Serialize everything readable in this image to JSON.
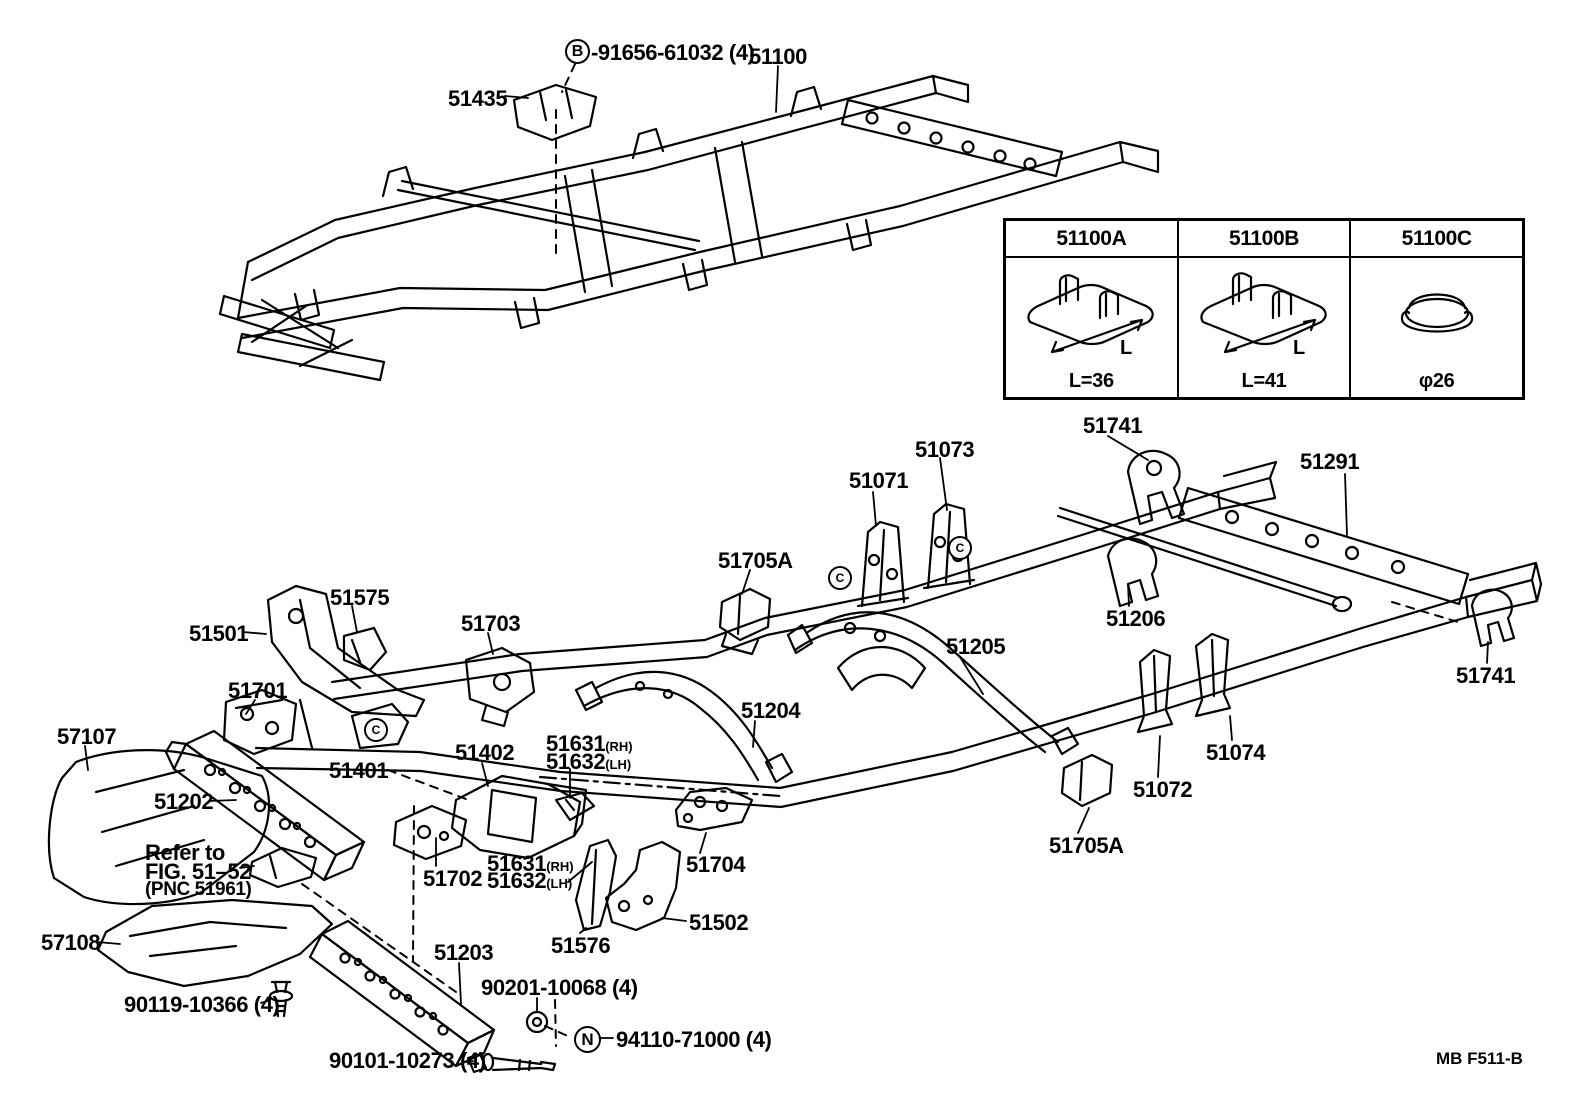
{
  "figure": {
    "code": "MB F511-B"
  },
  "symbols": {
    "b": "B",
    "n": "N",
    "c": "C"
  },
  "note": {
    "l1": "Refer to",
    "l2": "FIG. 51–52",
    "l3": "(PNC 51961)"
  },
  "table": {
    "dim_letter": "L",
    "columns": [
      {
        "header": "51100A",
        "dim": "L=36",
        "icon": "frame-clip"
      },
      {
        "header": "51100B",
        "dim": "L=41",
        "icon": "frame-clip"
      },
      {
        "header": "51100C",
        "dim": "φ26",
        "icon": "hole-plug"
      }
    ]
  },
  "labels": {
    "b_bolt": "-91656-61032 (4)",
    "frame": "51100",
    "p51435": "51435",
    "p51741": "51741",
    "p51073": "51073",
    "p51071": "51071",
    "p51291": "51291",
    "p51705a": "51705A",
    "p51206": "51206",
    "p51575": "51575",
    "p51501": "51501",
    "p51703": "51703",
    "p51701": "51701",
    "p51205": "51205",
    "p51204": "51204",
    "p57107": "57107",
    "p51631": "51631",
    "p51632": "51632",
    "sfx_rh": "(RH)",
    "sfx_lh": "(LH)",
    "p51402": "51402",
    "p51401": "51401",
    "p51074": "51074",
    "p51202": "51202",
    "p51072": "51072",
    "p51702": "51702",
    "p51704": "51704",
    "p51502": "51502",
    "p51576": "51576",
    "p57108": "57108",
    "p51203": "51203",
    "b90119": "90119-10366 (4)",
    "b90201": "90201-10068 (4)",
    "b90101": "90101-10273 (4)",
    "n94110": "94110-71000 (4)"
  }
}
